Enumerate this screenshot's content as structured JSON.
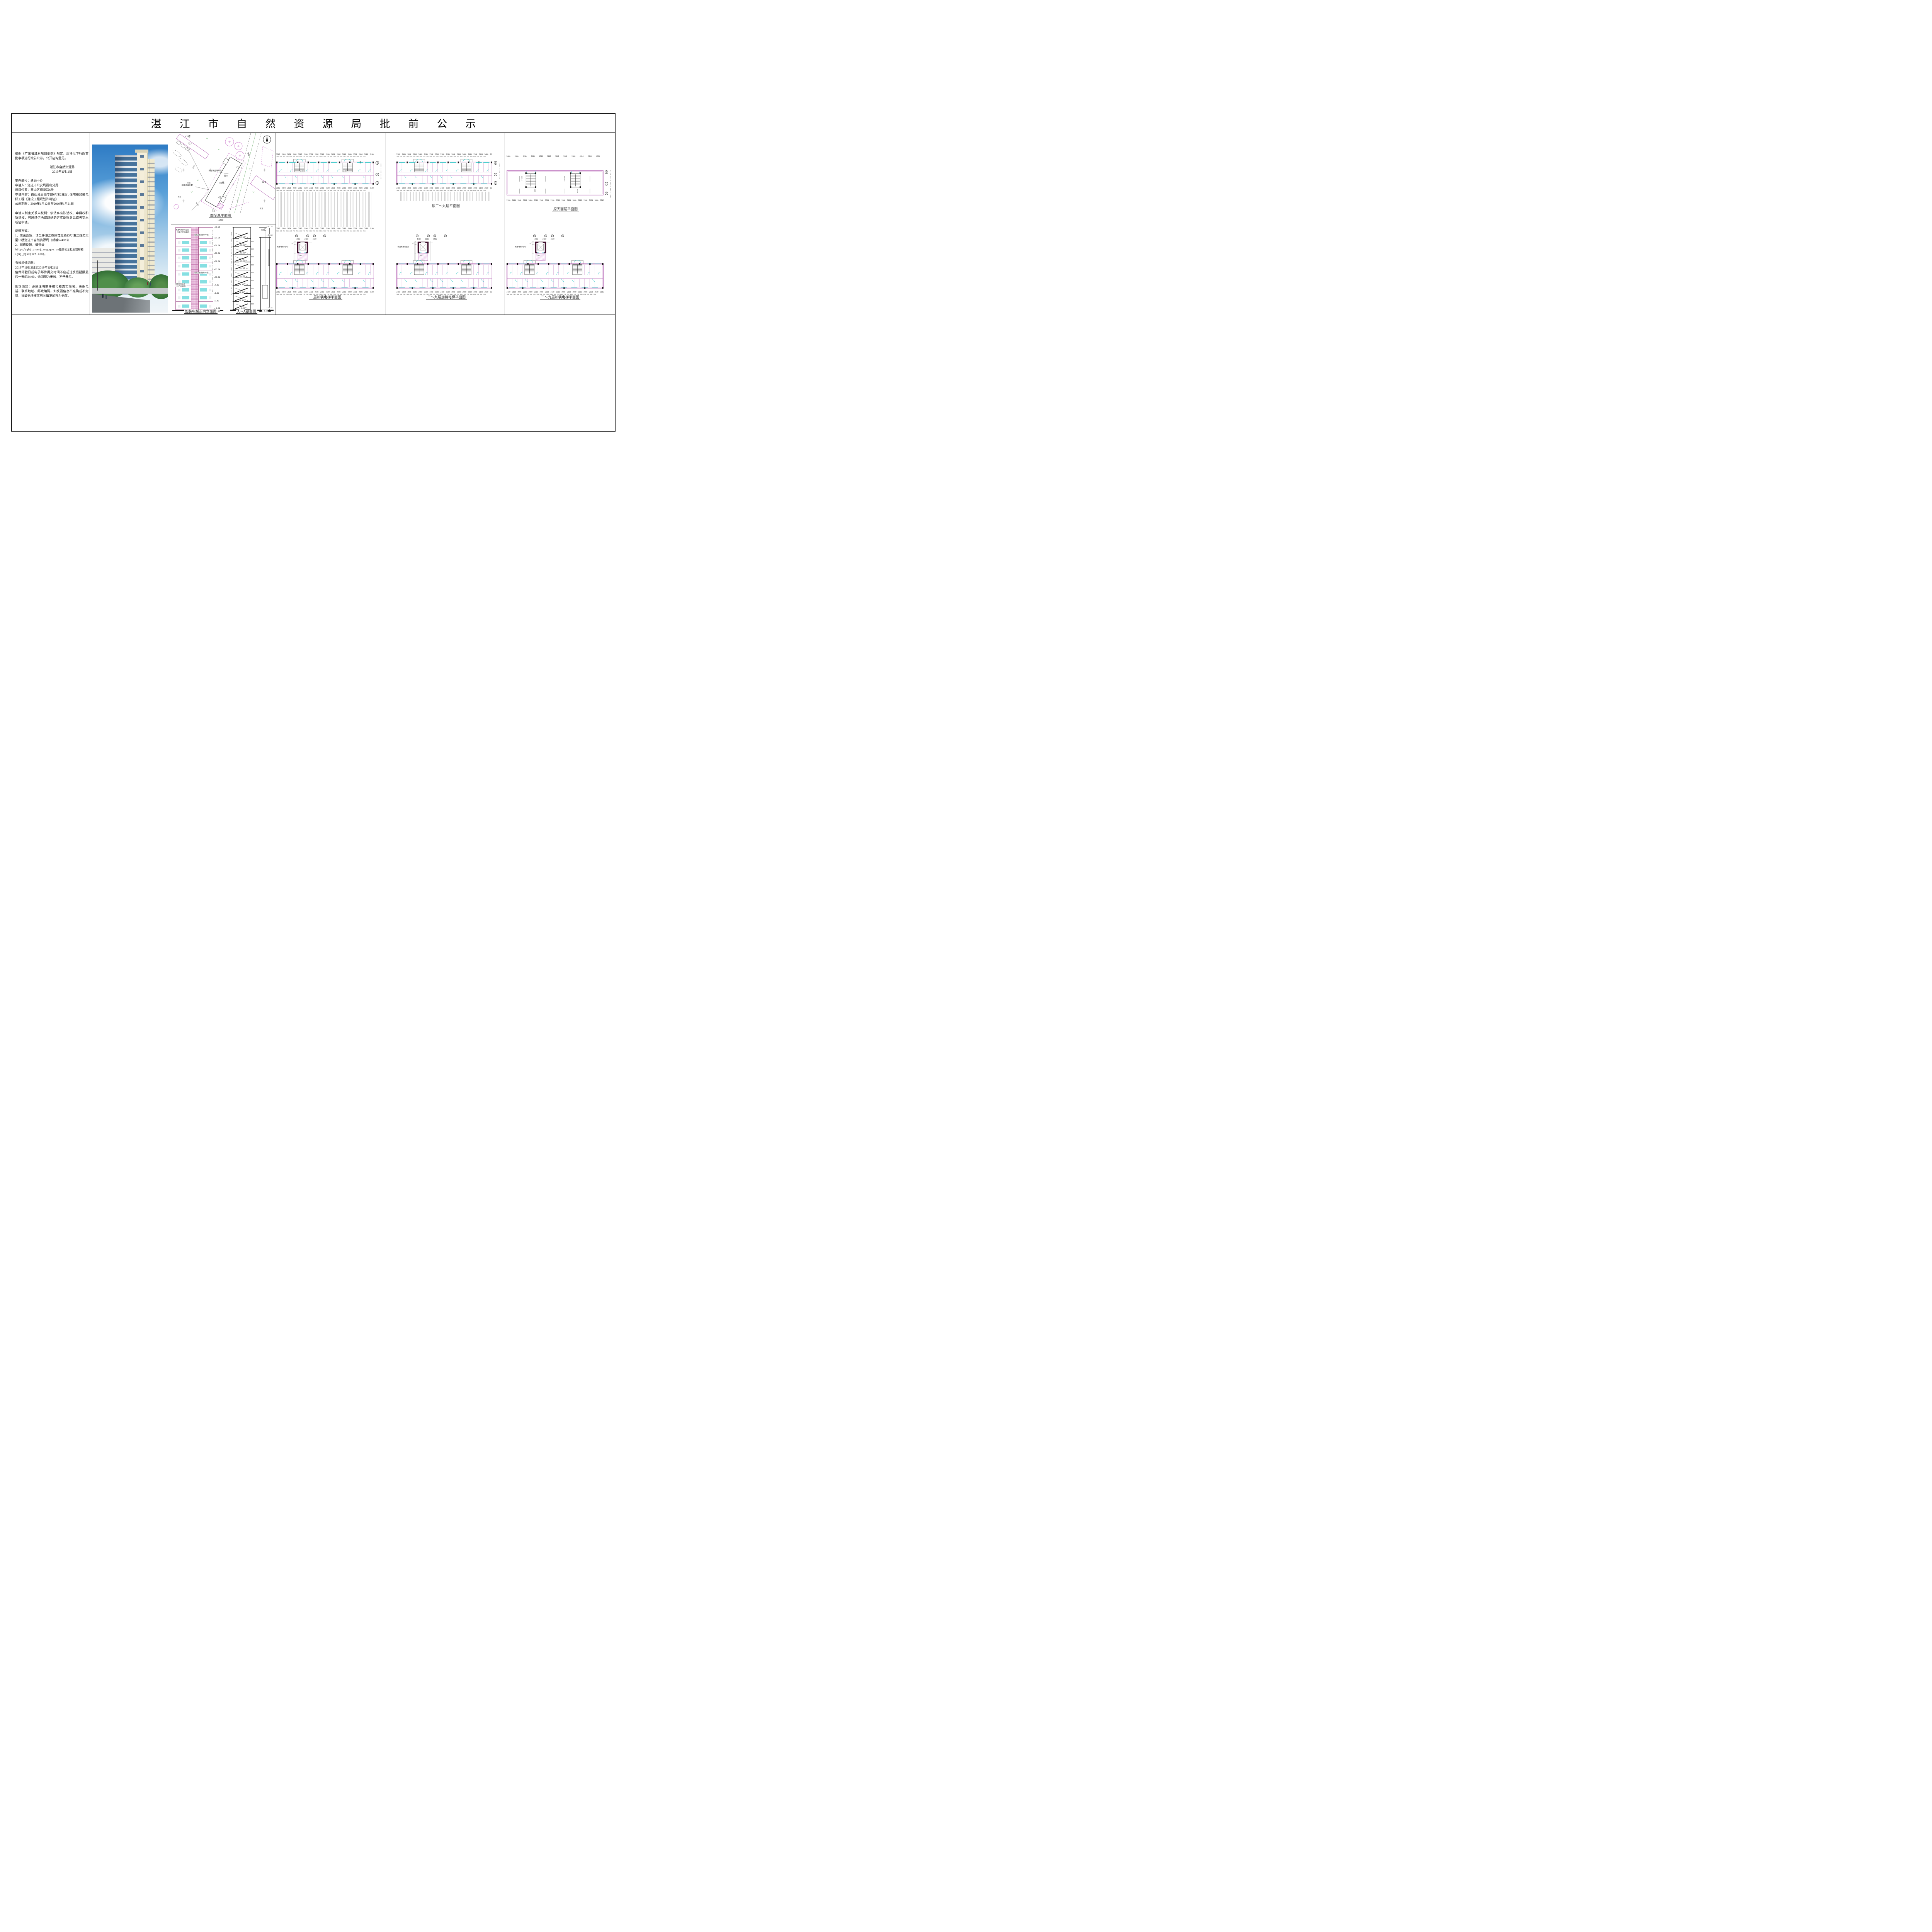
{
  "title": "湛江市自然资源局批前公示",
  "notice": {
    "intro": "根据《广东省城乡规划条例》规定，现将以下行政审批事项进行批前公示，公开征询意见。",
    "agency": "湛江市自然资源局",
    "date": "2019年1月11日",
    "case_no": "案件编号：建18-440",
    "applicant": "申请人：湛江市公安局霞山分局",
    "location": "项目位置：霞山区绿华路6号",
    "content_line": "申请内容：霞山分局绿华路6号E2栋2门住宅楼加装电梯工程《建设工程规划许可证》",
    "period": "公示期限：2019年1月12日至2019年1月21日",
    "rights": "申请人利害关系人权利：依法享有陈述权、申辩权和听证权，可通过信函或网络的方式反馈意见或者提出听证申请。",
    "feedback_title": "反馈方式：",
    "feedback_1": "1、信函反馈，请至件湛江市体育北路15号湛江商务大厦10楼湛江市自然资源局（邮编524023）",
    "feedback_2": "2、网络反馈，请登录",
    "feedback_url": "http://ghj.zhanjiang.gov.cn指前公示栏反馈邮箱",
    "feedback_email": "(ghj_yjxx@126.com)。",
    "valid_title": "有效反馈期限：",
    "valid_period": "2019年1月12日至2019年1月21日",
    "valid_note": "信件邮戳日或电子邮件提交时间不应超过反馈期限最后一天的24:00，逾期视为无效，不予参考。",
    "notes": "反馈须知：必须注明案件编号和真实姓名、联系电话、联系地址、邮政编码，如反馈信息不准确或不完整，导致无法核实有关情况的视为无效。"
  },
  "site_plan": {
    "caption": "四至总平面图",
    "scale": "1:200",
    "c2": "C2栋",
    "tong9a": "砼 9",
    "tong9b": "砼 9",
    "e2": "E2栋",
    "num8": "8",
    "tong8": "砼 8",
    "door1": "1门",
    "door2": "2门",
    "cement": "水泥",
    "dim1": "25.80",
    "dim2": "16.13",
    "elevator_label": "拟建电梯位置",
    "balcony_label": "阳台防盗网外飘",
    "cable": "电缆"
  },
  "elevation": {
    "caption": "加装电梯正向立面图",
    "levels": [
      "31.20",
      "27.00",
      "24.00",
      "21.00",
      "18.00",
      "15.00",
      "12.00",
      "9.00",
      "6.00",
      "3.00",
      "-0.30",
      "-0.45"
    ],
    "heights": "4200 3000 3000 3000 3000 3000 3000 3000 3008 3292 150",
    "callout_top_1": "新加电梯部分立面",
    "callout_top_2": "（贴奶白色纸皮砖）",
    "callout_400": "(贴灰蓝色纸皮砖400宽)",
    "callout_300": "(贴灰蓝色纸皮砖300宽)",
    "callout_left_1": "宿舍部分立面",
    "callout_left_2": "（白色外墙砖）"
  },
  "section": {
    "caption": "A～A剖面图",
    "top_level": "31.20",
    "machine_level": "28.60",
    "base_level": "-0.45",
    "pit_level": "-1.80",
    "machine_room": "机房",
    "md": "MD",
    "stair_levels": [
      "27.00",
      "24.00",
      "21.00",
      "18.00",
      "15.00",
      "12.00",
      "9.00",
      "6.00",
      "3.00",
      "-0.30"
    ],
    "heights": "4200 3000 3000 3000 3000 3000 3000 3000 3000 3300 1500"
  },
  "plans": {
    "axis_dims": "2100 2000 2000 2000 2000 2100 2100 2600 2100 2100 2000 2000 2000 2000 2100 2100 2600 2100",
    "opening_dims": "700 600 700 700 600 700 750 600 750 750 600 750 300 2000 300 750 600 750 750 600 750 750 600 650 650 600 750",
    "roof_dims": "2000 2000 4200 2600 4200 2000 2000 2000 2000 4200 2600 4200 2000 2000",
    "side_dims": "3900 1800 4800",
    "roof_side_dims": "1500 3900 1800 4800 1500",
    "detail_dims": "4500 2600 4500",
    "grid_j": "J",
    "grid_g": "G",
    "grid_e": "E",
    "bub7": "7",
    "bub8": "8",
    "bub10": "10",
    "bub11": "11",
    "shaft_label": "新加电梯间部分",
    "md": "MD",
    "level_zero": "±0.00",
    "slope": "i=1.5%",
    "captions": {
      "col4_bottom": "一层加装电梯平面图",
      "col5_top": "原二～九层平面图",
      "col5_bottom": "二～九层加装电梯平面图",
      "col6_top": "原天面层平面图",
      "col6_bottom": "二～九层加装电梯平面图"
    }
  },
  "colors": {
    "wall_magenta": "#b565b5",
    "cyan": "#2fc7c7",
    "shaft_dark": "#40102e",
    "sky_blue": "#2e7bc4",
    "ink": "#1a1a1a"
  }
}
